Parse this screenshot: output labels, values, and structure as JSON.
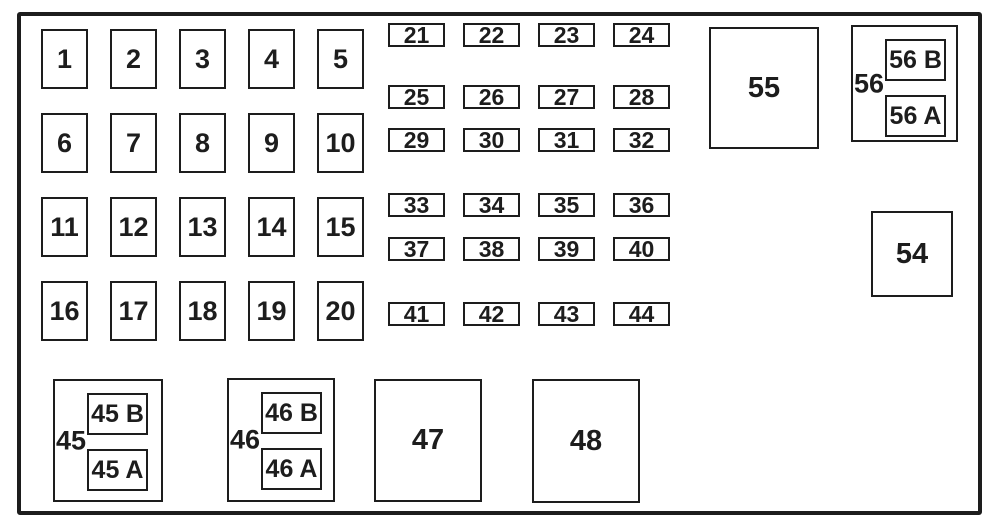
{
  "colors": {
    "line": "#1d1d1d",
    "text": "#1d1d1d",
    "background": "#ffffff"
  },
  "panel": {
    "square_fuses": [
      "1",
      "2",
      "3",
      "4",
      "5",
      "6",
      "7",
      "8",
      "9",
      "10",
      "11",
      "12",
      "13",
      "14",
      "15",
      "16",
      "17",
      "18",
      "19",
      "20"
    ],
    "mini_fuse_rows": [
      [
        "21",
        "22",
        "23",
        "24"
      ],
      [
        "25",
        "26",
        "27",
        "28"
      ],
      [
        "29",
        "30",
        "31",
        "32"
      ],
      [
        "33",
        "34",
        "35",
        "36"
      ],
      [
        "37",
        "38",
        "39",
        "40"
      ],
      [
        "41",
        "42",
        "43",
        "44"
      ]
    ],
    "relay_45": {
      "label": "45",
      "top": "45 B",
      "bottom": "45 A"
    },
    "relay_46": {
      "label": "46",
      "top": "46 B",
      "bottom": "46 A"
    },
    "box_47_label": "47",
    "box_48_label": "48",
    "box_55_label": "55",
    "relay_56": {
      "label": "56",
      "top": "56 B",
      "bottom": "56 A"
    },
    "box_54_label": "54"
  }
}
